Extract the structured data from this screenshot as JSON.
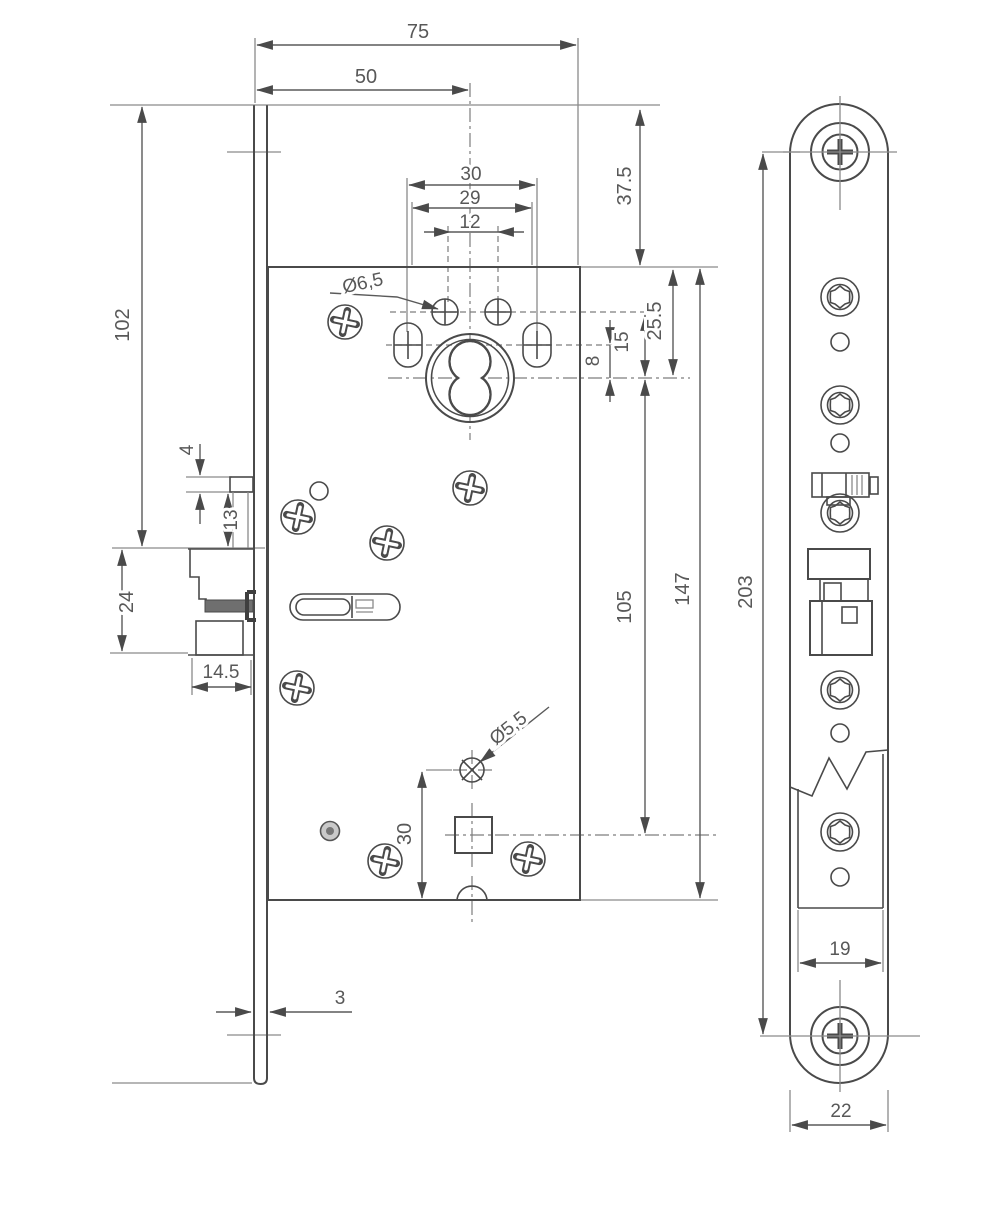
{
  "drawing": {
    "dims": {
      "d75": "75",
      "d50": "50",
      "d30_top": "30",
      "d29": "29",
      "d12": "12",
      "dia6_5": "Ø6,5",
      "d37_5": "37.5",
      "d25_5": "25.5",
      "d15": "15",
      "d8": "8",
      "d102": "102",
      "d4": "4",
      "d13": "13",
      "d24": "24",
      "d14_5": "14.5",
      "d105": "105",
      "d147": "147",
      "dia5_5": "Ø5,5",
      "d30_bottom": "30",
      "d3": "3",
      "d203": "203",
      "d19": "19",
      "d22": "22"
    }
  }
}
